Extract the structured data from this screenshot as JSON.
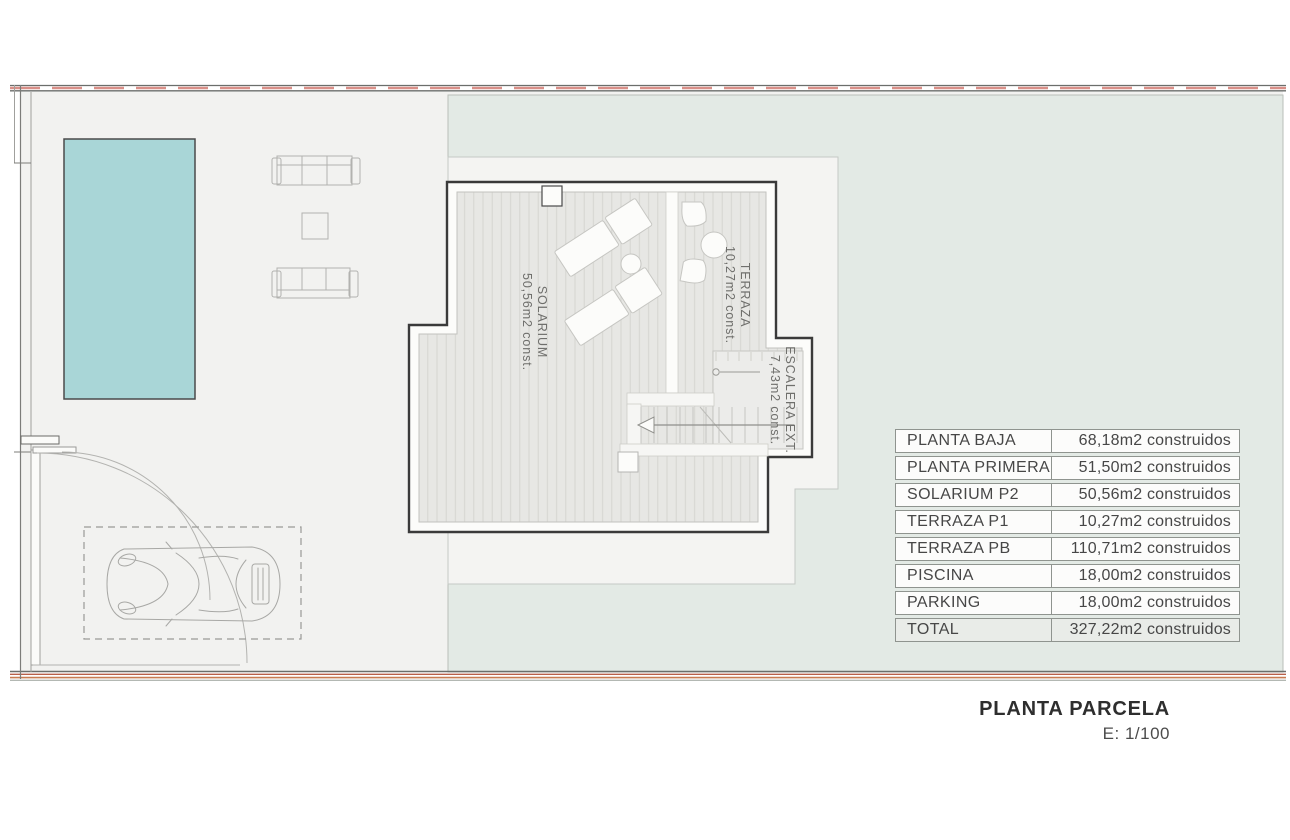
{
  "plan": {
    "labels": {
      "solarium": {
        "name": "SOLARIUM",
        "area": "50,56m2 const."
      },
      "terraza": {
        "name": "TERRAZA",
        "area": "10,27m2 const."
      },
      "escalera": {
        "name": "ESCALERA EXT.",
        "area": "7,43m2 const."
      }
    }
  },
  "areas_table": {
    "rows": [
      {
        "label": "PLANTA BAJA",
        "value": "68,18m2 construidos"
      },
      {
        "label": "PLANTA PRIMERA",
        "value": "51,50m2 construidos"
      },
      {
        "label": "SOLARIUM P2",
        "value": "50,56m2 construidos"
      },
      {
        "label": "TERRAZA P1",
        "value": "10,27m2 construidos"
      },
      {
        "label": "TERRAZA PB",
        "value": "110,71m2 construidos"
      },
      {
        "label": "PISCINA",
        "value": "18,00m2 construidos"
      },
      {
        "label": "PARKING",
        "value": "18,00m2 construidos"
      },
      {
        "label": "TOTAL",
        "value": "327,22m2 construidos"
      }
    ]
  },
  "title_block": {
    "title": "PLANTA PARCELA",
    "scale": "E: 1/100"
  },
  "colors": {
    "pool": "#a9d6d7",
    "parcel_green": "#e3eae5",
    "boundary_red": "#d98f88",
    "boundary_orange": "#c87c52"
  }
}
